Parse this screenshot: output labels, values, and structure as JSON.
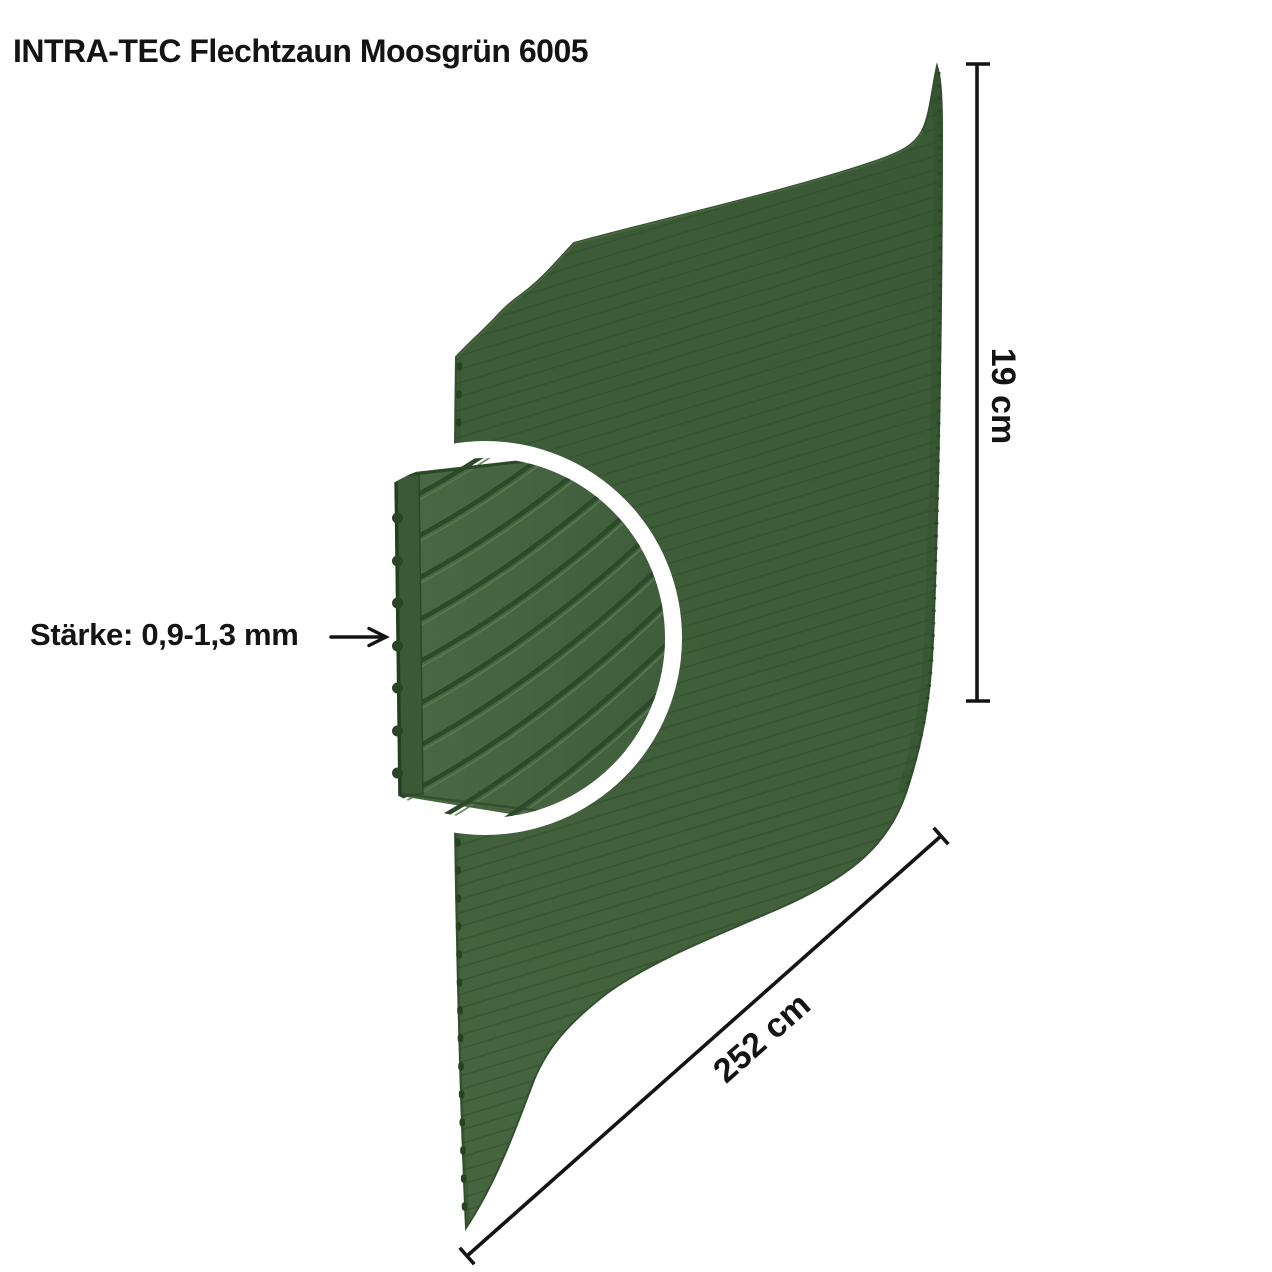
{
  "title": "INTRA-TEC Flechtzaun Moosgrün 6005",
  "product": {
    "brand": "INTRA-TEC",
    "product_type": "Flechtzaun",
    "color_name": "Moosgrün",
    "ral_code": "6005"
  },
  "annotations": {
    "thickness_label": "Stärke: 0,9-1,3 mm",
    "height_label": "19 cm",
    "length_label": "252 cm"
  },
  "icons": {
    "thickness_arrow": "right-arrow"
  },
  "colors": {
    "moss_green": "#41603a",
    "moss_green_dark": "#33512e",
    "groove_line": "#2e4c2a",
    "edge_dark": "#243f1f",
    "magnifier_ring": "#ffffff",
    "annotation_text": "#141414",
    "background": "#ffffff"
  }
}
